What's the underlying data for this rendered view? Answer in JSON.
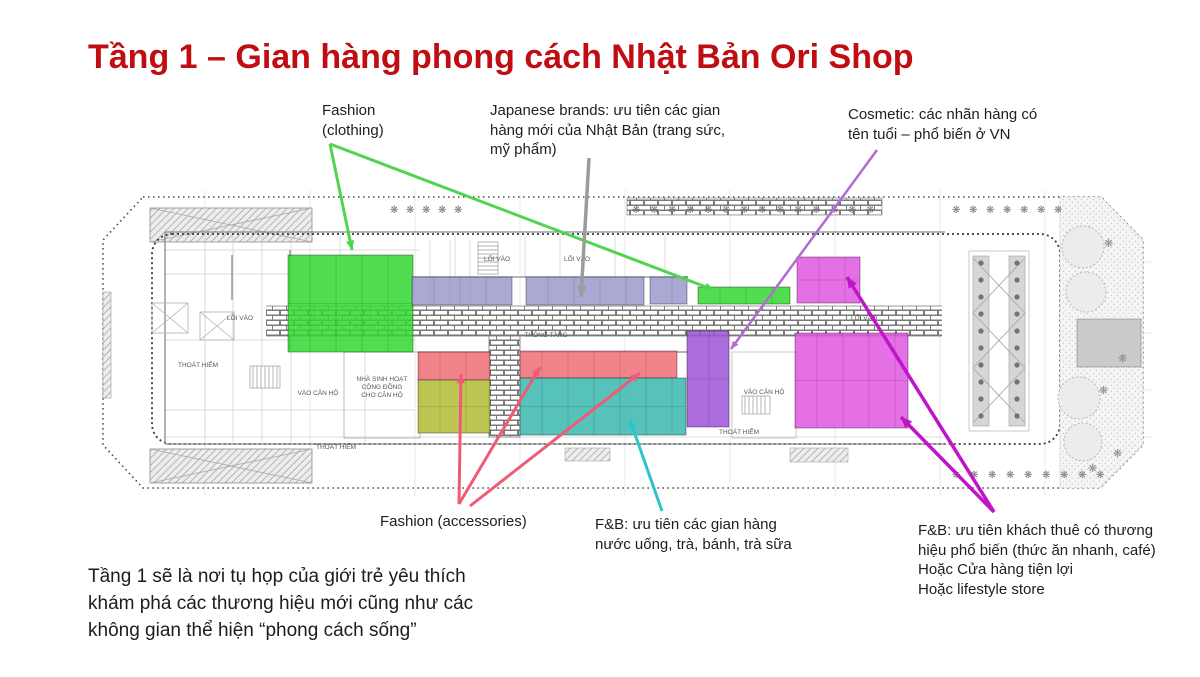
{
  "slide": {
    "title": "Tầng 1 – Gian hàng phong cách Nhật Bản Ori Shop",
    "footer": "Tầng 1 sẽ là nơi tụ họp của giới trẻ yêu thích\nkhám phá các thương hiệu mới cũng như các\nkhông gian thể hiện “phong cách sống”"
  },
  "colors": {
    "title": "#c00d12",
    "green": "#31d831",
    "lavender": "#9b9acb",
    "purple": "#9c52d8",
    "magenta": "#e156e1",
    "red": "#ee6d75",
    "olive": "#b2bc35",
    "teal": "#3ab7ad",
    "arrow_green": "#52d452",
    "arrow_gray": "#9c9c9c",
    "arrow_violet": "#b36ad4",
    "arrow_pink": "#ef5b76",
    "arrow_cyan": "#2cc4cc",
    "arrow_magenta": "#c014c9"
  },
  "annotations": [
    {
      "id": "fashion-clothing-note",
      "text": "Fashion\n(clothing)",
      "x": 322,
      "y": 101,
      "w": 160
    },
    {
      "id": "japanese-brands-note",
      "text": "Japanese brands: ưu tiên các gian\nhàng mới của Nhật Bản (trang sức,\nmỹ phẩm)",
      "x": 490,
      "y": 101,
      "w": 265
    },
    {
      "id": "cosmetic-note",
      "text": "Cosmetic: các nhãn hàng có\ntên tuổi – phổ biến ở VN",
      "x": 848,
      "y": 105,
      "w": 250
    },
    {
      "id": "fashion-accessories-note",
      "text": "Fashion (accessories)",
      "x": 380,
      "y": 512,
      "w": 210
    },
    {
      "id": "fnb-kiosk-note",
      "text": "F&B: ưu tiên các gian hàng\nnước uống, trà, bánh, trà sữa",
      "x": 595,
      "y": 515,
      "w": 235
    },
    {
      "id": "fnb-brand-note",
      "text": "F&B: ưu tiên khách thuê có thương\nhiệu phổ biến (thức ăn nhanh, café)\nHoặc Cửa hàng tiện lợi\nHoặc lifestyle store",
      "x": 918,
      "y": 521,
      "w": 270
    }
  ],
  "zones": [
    {
      "name": "fashion-clothing-zone",
      "color_key": "green",
      "rects": [
        [
          288,
          255,
          125,
          97
        ],
        [
          698,
          287,
          92,
          17
        ]
      ]
    },
    {
      "name": "japanese-brands-zone",
      "color_key": "lavender",
      "rects": [
        [
          412,
          277,
          100,
          28
        ],
        [
          526,
          277,
          118,
          28
        ],
        [
          650,
          277,
          37,
          27
        ]
      ]
    },
    {
      "name": "cosmetic-zone",
      "color_key": "purple",
      "rects": [
        [
          687,
          331,
          42,
          96
        ]
      ]
    },
    {
      "name": "fnb-brand-zone",
      "color_key": "magenta",
      "rects": [
        [
          797,
          257,
          63,
          46
        ],
        [
          795,
          333,
          113,
          95
        ]
      ]
    },
    {
      "name": "fashion-accessories-red-zone",
      "color_key": "red",
      "rects": [
        [
          418,
          352,
          72,
          28
        ],
        [
          520,
          351,
          157,
          27
        ]
      ]
    },
    {
      "name": "fashion-accessories-olive-zone",
      "color_key": "olive",
      "rects": [
        [
          418,
          380,
          72,
          53
        ]
      ]
    },
    {
      "name": "fnb-kiosk-zone",
      "color_key": "teal",
      "rects": [
        [
          520,
          378,
          166,
          57
        ]
      ]
    }
  ],
  "plan_labels": [
    {
      "text": "LỐI VÀO",
      "x": 240,
      "y": 320
    },
    {
      "text": "LỐI VÀO",
      "x": 497,
      "y": 261
    },
    {
      "text": "LỐI VÀO",
      "x": 577,
      "y": 261
    },
    {
      "text": "LỐI VÀO",
      "x": 864,
      "y": 320
    },
    {
      "text": "THOÁT HIỂM",
      "x": 198,
      "y": 367
    },
    {
      "text": "THOÁT HIỂM",
      "x": 336,
      "y": 449
    },
    {
      "text": "THOÁT HIỂM",
      "x": 739,
      "y": 434
    },
    {
      "text": "VÀO CĂN HỘ",
      "x": 318,
      "y": 395
    },
    {
      "text": "VÀO CĂN HỘ",
      "x": 764,
      "y": 394
    },
    {
      "text": "NHÀ SINH HOẠT\nCỘNG ĐỒNG\nCHO CĂN HỘ",
      "x": 382,
      "y": 381
    },
    {
      "text": "THÔNG TẦNG",
      "x": 546,
      "y": 337
    }
  ],
  "arrows": [
    {
      "name": "fashion-clothing-arrow-1",
      "color_key": "arrow_green",
      "from": [
        330,
        144
      ],
      "to": [
        352,
        250
      ],
      "w": 3
    },
    {
      "name": "fashion-clothing-arrow-2",
      "color_key": "arrow_green",
      "from": [
        330,
        144
      ],
      "to": [
        714,
        290
      ],
      "w": 3
    },
    {
      "name": "japanese-brands-arrow",
      "color_key": "arrow_gray",
      "from": [
        589,
        158
      ],
      "to": [
        581,
        297
      ],
      "w": 3.5
    },
    {
      "name": "cosmetic-arrow",
      "color_key": "arrow_violet",
      "from": [
        877,
        150
      ],
      "to": [
        731,
        349
      ],
      "w": 2.5
    },
    {
      "name": "fashion-accessories-arrow-1",
      "color_key": "arrow_pink",
      "from": [
        459,
        504
      ],
      "to": [
        461,
        374
      ],
      "w": 3
    },
    {
      "name": "fashion-accessories-arrow-2",
      "color_key": "arrow_pink",
      "from": [
        459,
        504
      ],
      "to": [
        540,
        367
      ],
      "w": 3
    },
    {
      "name": "fashion-accessories-arrow-3",
      "color_key": "arrow_pink",
      "from": [
        470,
        506
      ],
      "to": [
        640,
        373
      ],
      "w": 3
    },
    {
      "name": "fnb-kiosk-arrow",
      "color_key": "arrow_cyan",
      "from": [
        662,
        511
      ],
      "to": [
        630,
        420
      ],
      "w": 3
    },
    {
      "name": "fnb-brand-arrow-1",
      "color_key": "arrow_magenta",
      "from": [
        994,
        512
      ],
      "to": [
        847,
        277
      ],
      "w": 3.5
    },
    {
      "name": "fnb-brand-arrow-2",
      "color_key": "arrow_magenta",
      "from": [
        994,
        512
      ],
      "to": [
        901,
        417
      ],
      "w": 3.5
    }
  ]
}
